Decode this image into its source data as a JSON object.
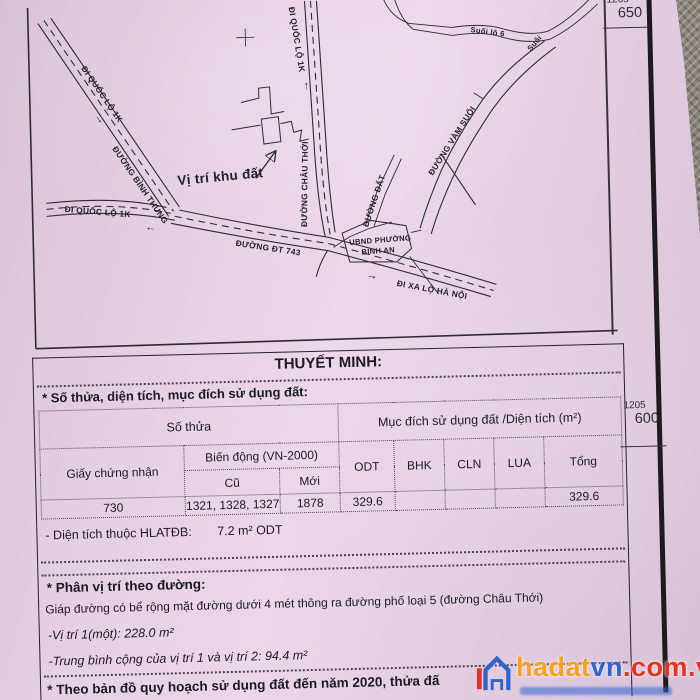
{
  "map": {
    "margin_labels": [
      {
        "sheet": "1205",
        "value": "650"
      },
      {
        "sheet": "1205",
        "value": "600"
      }
    ],
    "roads": {
      "di_quoc_lo_1k": "ĐI QUỐC LỘ 1K",
      "duong_binh_thung": "ĐƯỜNG BÌNH THUNG",
      "duong_dt_743": "ĐƯỜNG ĐT 743",
      "di_xa_lo_ha_noi": "ĐI XA LỘ HÀ NỘI",
      "duong_chau_thoi": "ĐƯỜNG CHÂU THỚI",
      "duong_vam_suoi": "ĐƯỜNG VÀM SUỐI",
      "duong_dat": "ĐƯỜNG ĐẤT",
      "suoi_lo_6": "Suối lô 6",
      "suoi": "Suối"
    },
    "annotations": {
      "vi_tri_khu_dat": "Vị trí khu đất",
      "ubnd_line1": "UBND PHƯỜNG",
      "ubnd_line2": "BÌNH AN"
    },
    "icons": {
      "left_arrow": "←",
      "right_arrow": "→",
      "up_arrow": "↑"
    }
  },
  "report": {
    "title": "THUYẾT MINH:",
    "section1_heading": "* Số thửa, diện tích, mục đích sử dụng đất:",
    "table": {
      "so_thua": "Số thửa",
      "muc_dich": "Mục đích sử dụng đất /Diện tích (m²)",
      "giay_chung_nhan": "Giấy chứng nhận",
      "bien_dong": "Biến động (VN-2000)",
      "cu": "Cũ",
      "moi": "Mới",
      "odt": "ODT",
      "bhk": "BHK",
      "cln": "CLN",
      "lua": "LUA",
      "tong": "Tổng",
      "row": {
        "giay_chung_nhan": "730",
        "cu": "1321, 1328, 1327",
        "moi": "1878",
        "odt": "329.6",
        "bhk": "",
        "cln": "",
        "lua": "",
        "tong": "329.6"
      }
    },
    "hlatdb_label": "- Diện tích thuộc HLATĐB:",
    "hlatdb_value": "7.2 m² ODT",
    "section2_heading": "* Phân vị trí theo đường:",
    "section2_line1": "Giáp đường có bể rộng mặt đường dưới 4 mét thông ra đường phố loại 5 (đường Châu Thới)",
    "section2_line2": "-Vị trí 1(một): 228.0 m²",
    "section2_line3": "-Trung bình cộng của vị trí 1 và vị trí 2:  94.4 m²",
    "section3_heading": "* Theo bản đồ quy hoạch sử dụng đất đến năm 2020, thửa đấ"
  },
  "watermark": {
    "part1": "hadat",
    "part2": "vn",
    "part3": ".com.vn",
    "colors": {
      "orange": "#f6a11f",
      "blue": "#2f63cf",
      "red": "#e5331f"
    }
  }
}
